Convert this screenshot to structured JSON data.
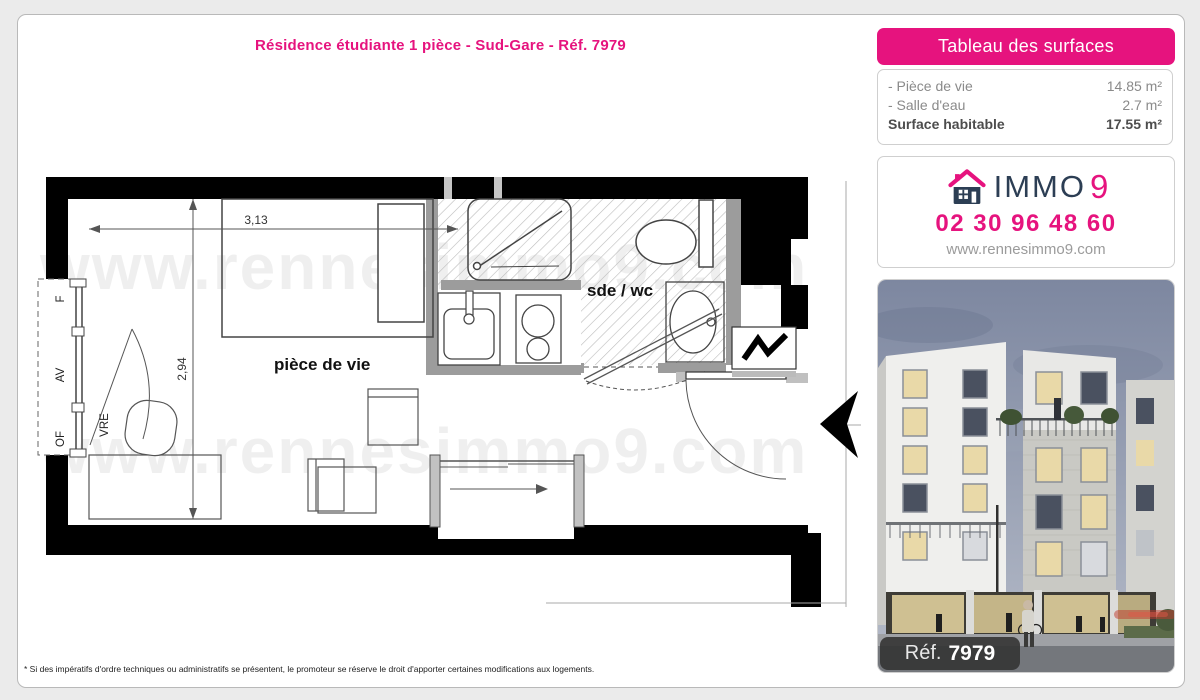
{
  "page": {
    "title": "Résidence étudiante 1 pièce - Sud-Gare - Réf. 7979",
    "footnote": "* Si des impératifs d'ordre techniques ou administratifs se présentent, le promoteur se réserve le droit d'apporter certaines modifications aux logements."
  },
  "surfaces": {
    "header": "Tableau des surfaces",
    "rows": [
      {
        "label": "- Pièce de vie",
        "value": "14.85 m²"
      },
      {
        "label": "- Salle d'eau",
        "value": "2.7 m²"
      }
    ],
    "total": {
      "label": "Surface habitable",
      "value": "17.55 m²"
    }
  },
  "agency": {
    "brand_text": "IMMO",
    "brand_digit": "9",
    "phone": "02 30 96 48 60",
    "website": "www.rennesimmo9.com"
  },
  "photo": {
    "ref_label": "Réf.",
    "ref_value": "7979"
  },
  "plan": {
    "room_main": "pièce de vie",
    "room_bath": "sde / wc",
    "dim_width": "3,13",
    "dim_height": "2,94",
    "window_labels": {
      "f": "F",
      "av": "AV",
      "of": "OF",
      "vre": "VRE"
    },
    "watermark": "www.rennesimmo9.com"
  },
  "colors": {
    "pink": "#e6137e",
    "navy": "#2c3e54"
  }
}
